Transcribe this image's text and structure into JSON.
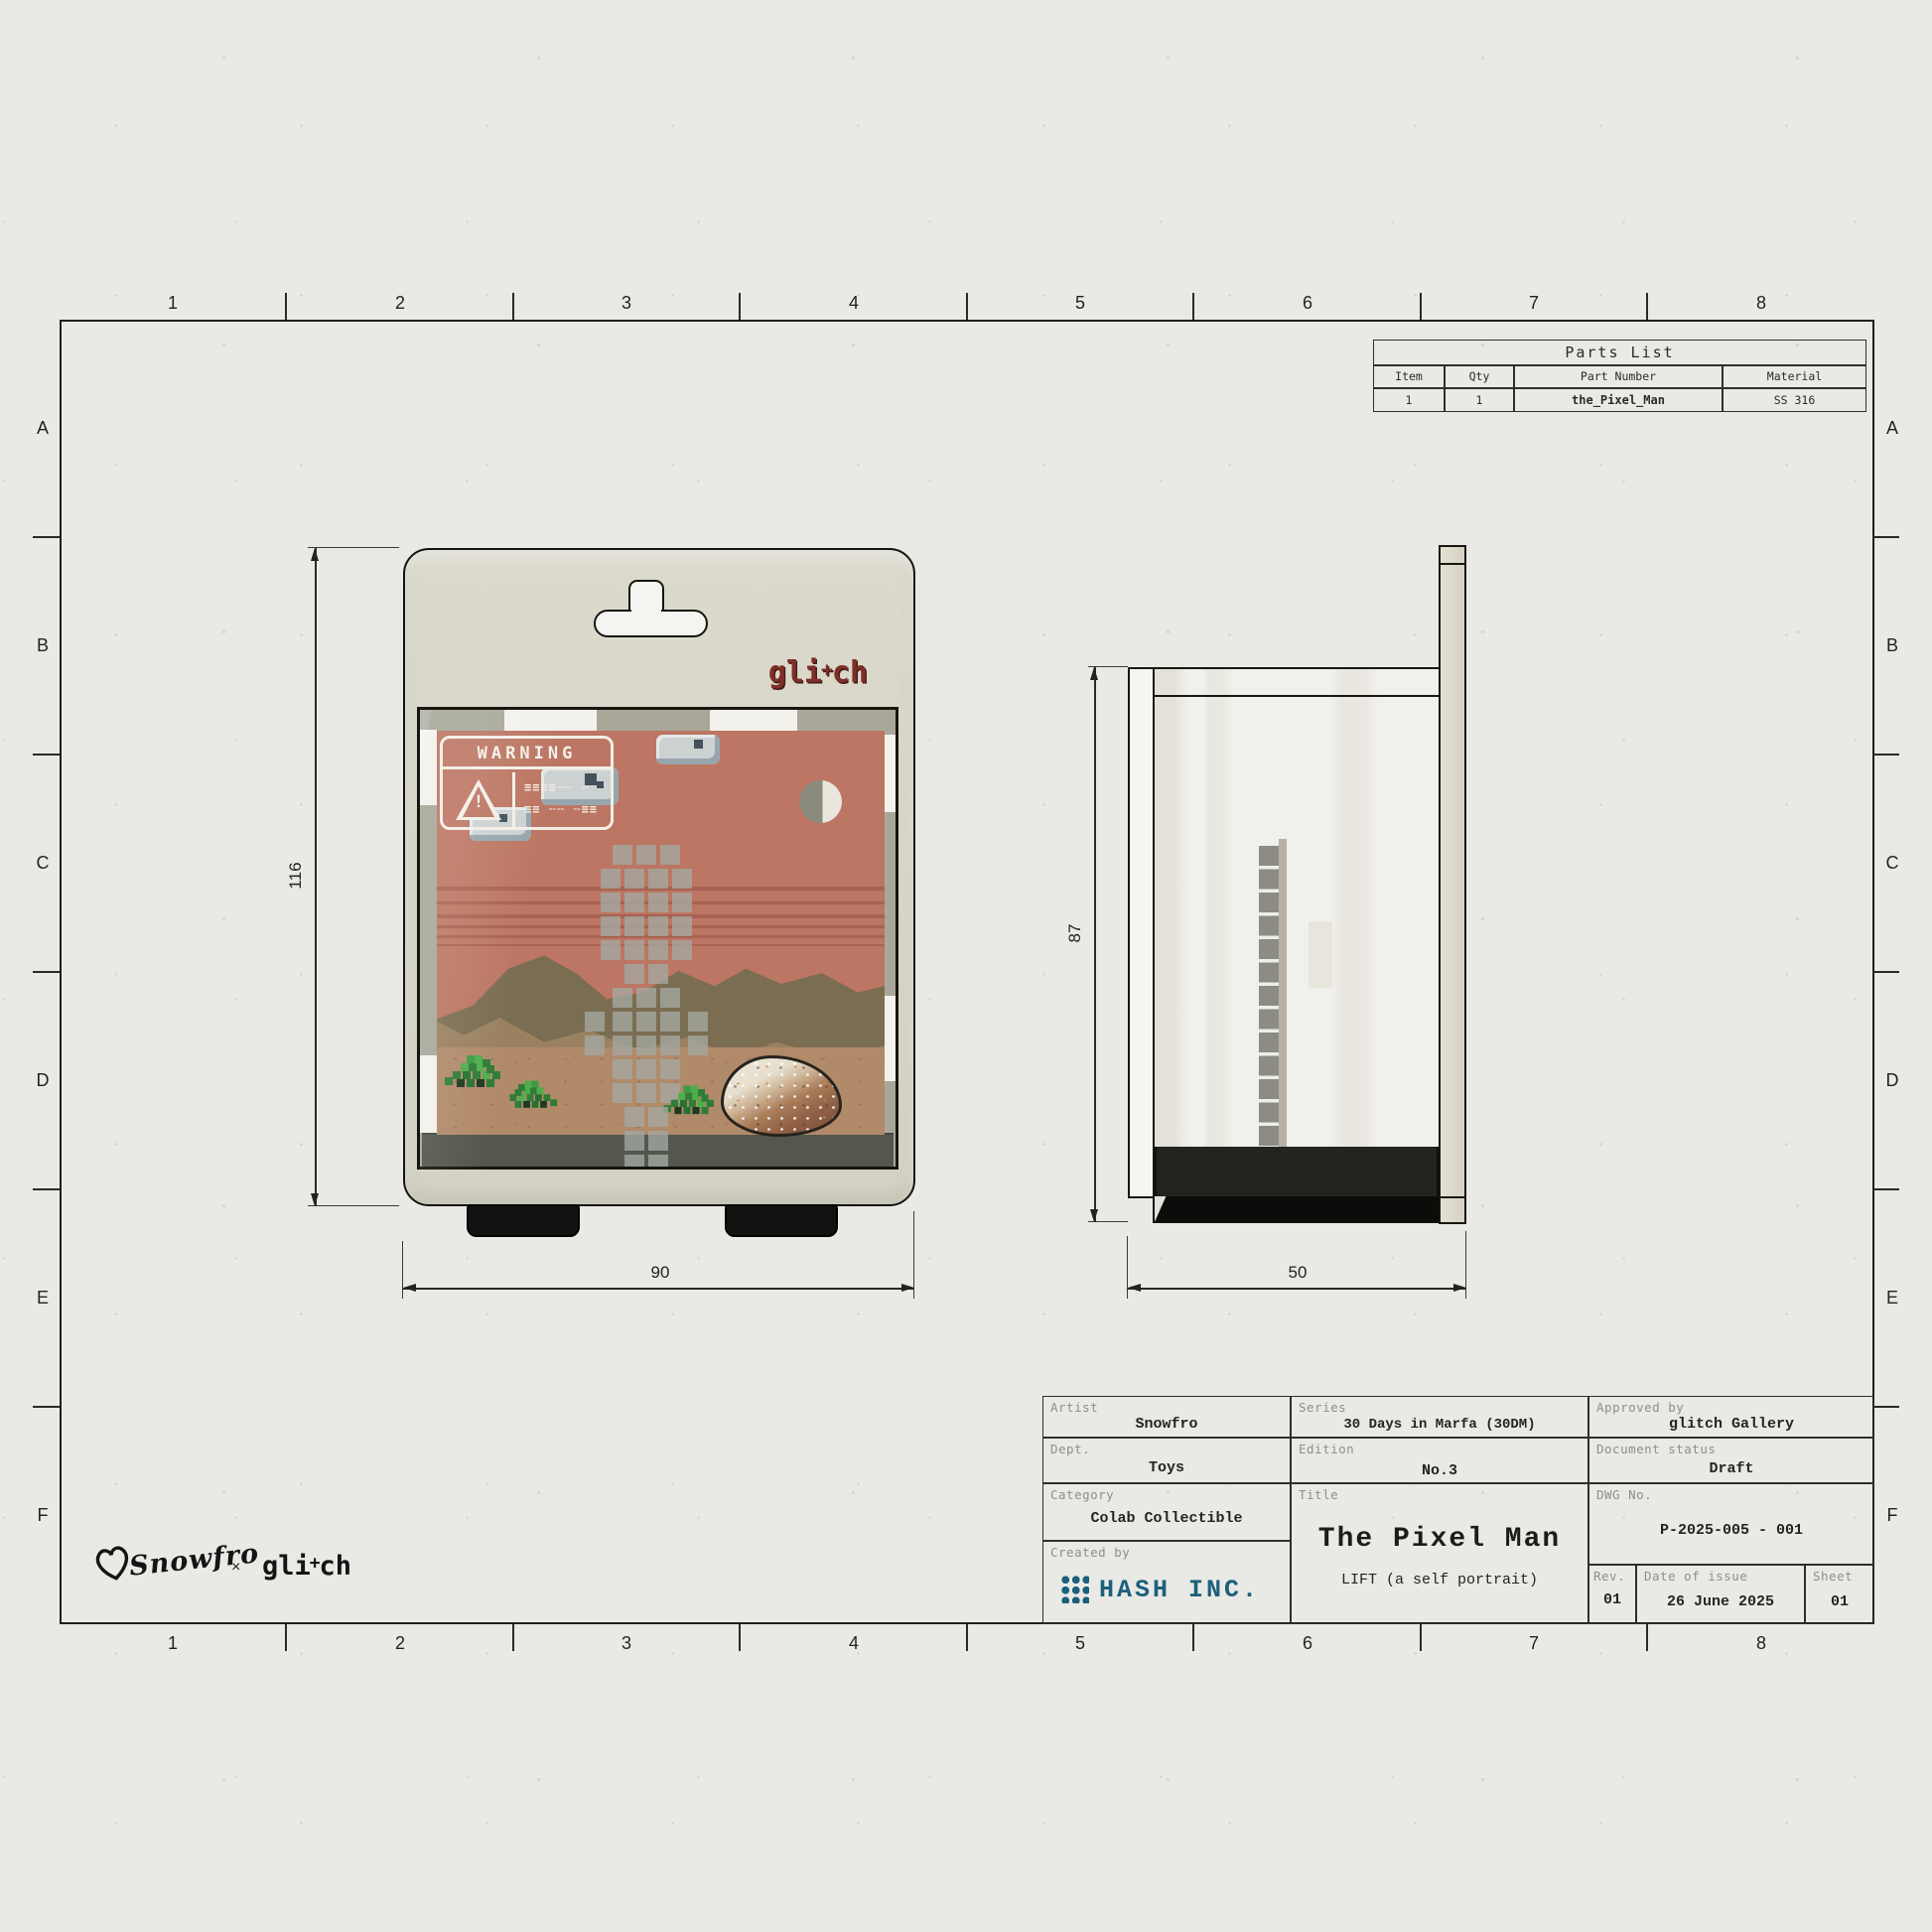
{
  "grid": {
    "cols": [
      "1",
      "2",
      "3",
      "4",
      "5",
      "6",
      "7",
      "8"
    ],
    "rows": [
      "A",
      "B",
      "C",
      "D",
      "E",
      "F"
    ]
  },
  "parts_list": {
    "title": "Parts List",
    "headers": {
      "item": "Item",
      "qty": "Qty",
      "part_number": "Part Number",
      "material": "Material"
    },
    "row": {
      "item": "1",
      "qty": "1",
      "part_number": "the_Pixel_Man",
      "material": "SS 316"
    }
  },
  "front_view": {
    "brand": {
      "pre": "gli",
      "plus": "+",
      "post": "ch"
    },
    "warning": {
      "title": "WARNING",
      "icon_mark": "!",
      "glitch_line_1": "≡≡≡≡╌╌ ╌",
      "glitch_line_2": "≡≡ ╌╌ ╌≡≡"
    },
    "dims": {
      "height": "116",
      "width": "90"
    }
  },
  "side_view": {
    "dims": {
      "height": "87",
      "width": "50"
    }
  },
  "title_block": {
    "artist": {
      "label": "Artist",
      "value": "Snowfro"
    },
    "dept": {
      "label": "Dept.",
      "value": "Toys"
    },
    "category": {
      "label": "Category",
      "value": "Colab Collectible"
    },
    "created_by": {
      "label": "Created by",
      "value": "HASH INC."
    },
    "series": {
      "label": "Series",
      "value": "30 Days in Marfa (30DM)"
    },
    "edition": {
      "label": "Edition",
      "value": "No.3"
    },
    "title": {
      "label": "Title",
      "value": "The Pixel Man",
      "subtitle": "LIFT (a self portrait)"
    },
    "approved_by": {
      "label": "Approved by",
      "value": "glitch Gallery"
    },
    "doc_status": {
      "label": "Document status",
      "value": "Draft"
    },
    "dwg_no": {
      "label": "DWG No.",
      "value": "P-2025-005 - 001"
    },
    "rev": {
      "label": "Rev.",
      "value": "01"
    },
    "date": {
      "label": "Date of issue",
      "value": "26 June 2025"
    },
    "sheet": {
      "label": "Sheet",
      "value": "01"
    }
  },
  "footer": {
    "signature": "Snowfro",
    "separator": "×",
    "brand": {
      "pre": "gli",
      "plus": "+",
      "post": "ch"
    }
  },
  "colors": {
    "accent_red": "#7d2f28",
    "hash_teal": "#1b607b",
    "card_beige": "#d8d7cb",
    "sky_salmon": "#bc7663"
  }
}
